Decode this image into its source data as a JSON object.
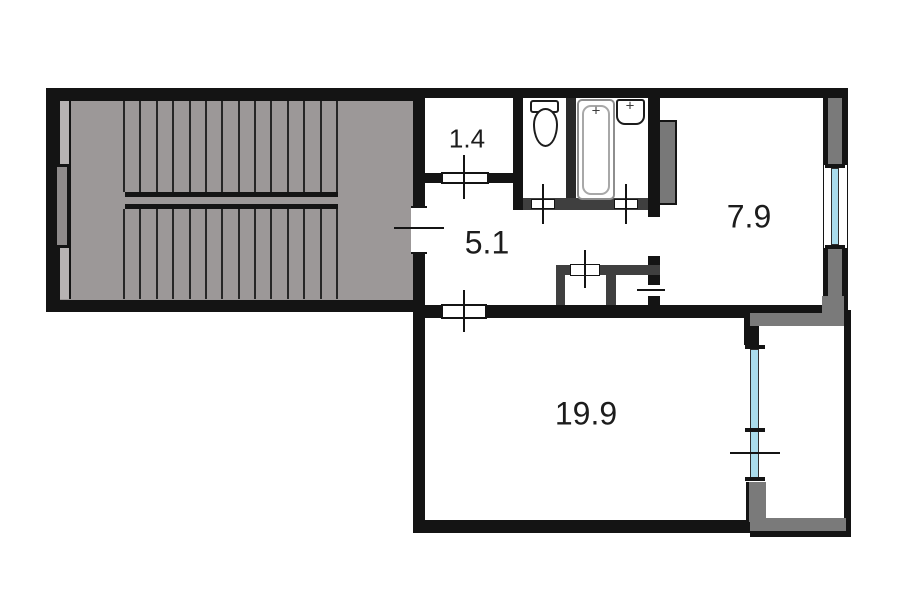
{
  "meta": {
    "type": "apartment-floor-plan-with-stairwell"
  },
  "rooms": {
    "r14": {
      "label": "1.4"
    },
    "r51": {
      "label": "5.1"
    },
    "r79": {
      "label": "7.9"
    },
    "r199": {
      "label": "19.9"
    }
  },
  "fixtures": {
    "list": [
      "staircase",
      "toilet",
      "bathtub",
      "sink",
      "vent-shaft",
      "balcony",
      "window"
    ]
  },
  "stairs": {
    "flights": 2,
    "treads_per_flight": 14
  },
  "glyphs": {
    "faucet": "+"
  },
  "colors": {
    "background": "#ffffff",
    "wall": "#141414",
    "partition": "#3f3f3f",
    "stair_fill": "#9c9898",
    "stair_strip": "#b7b3b3",
    "stair_window": "#8e8a8a",
    "tread": "#262626",
    "shaft_fill": "#787878",
    "balcony_wall": "#7a7a7a",
    "window_glass": "#aadcec",
    "tub_outline": "#8e8e8e",
    "label": "#1c1c1c"
  }
}
